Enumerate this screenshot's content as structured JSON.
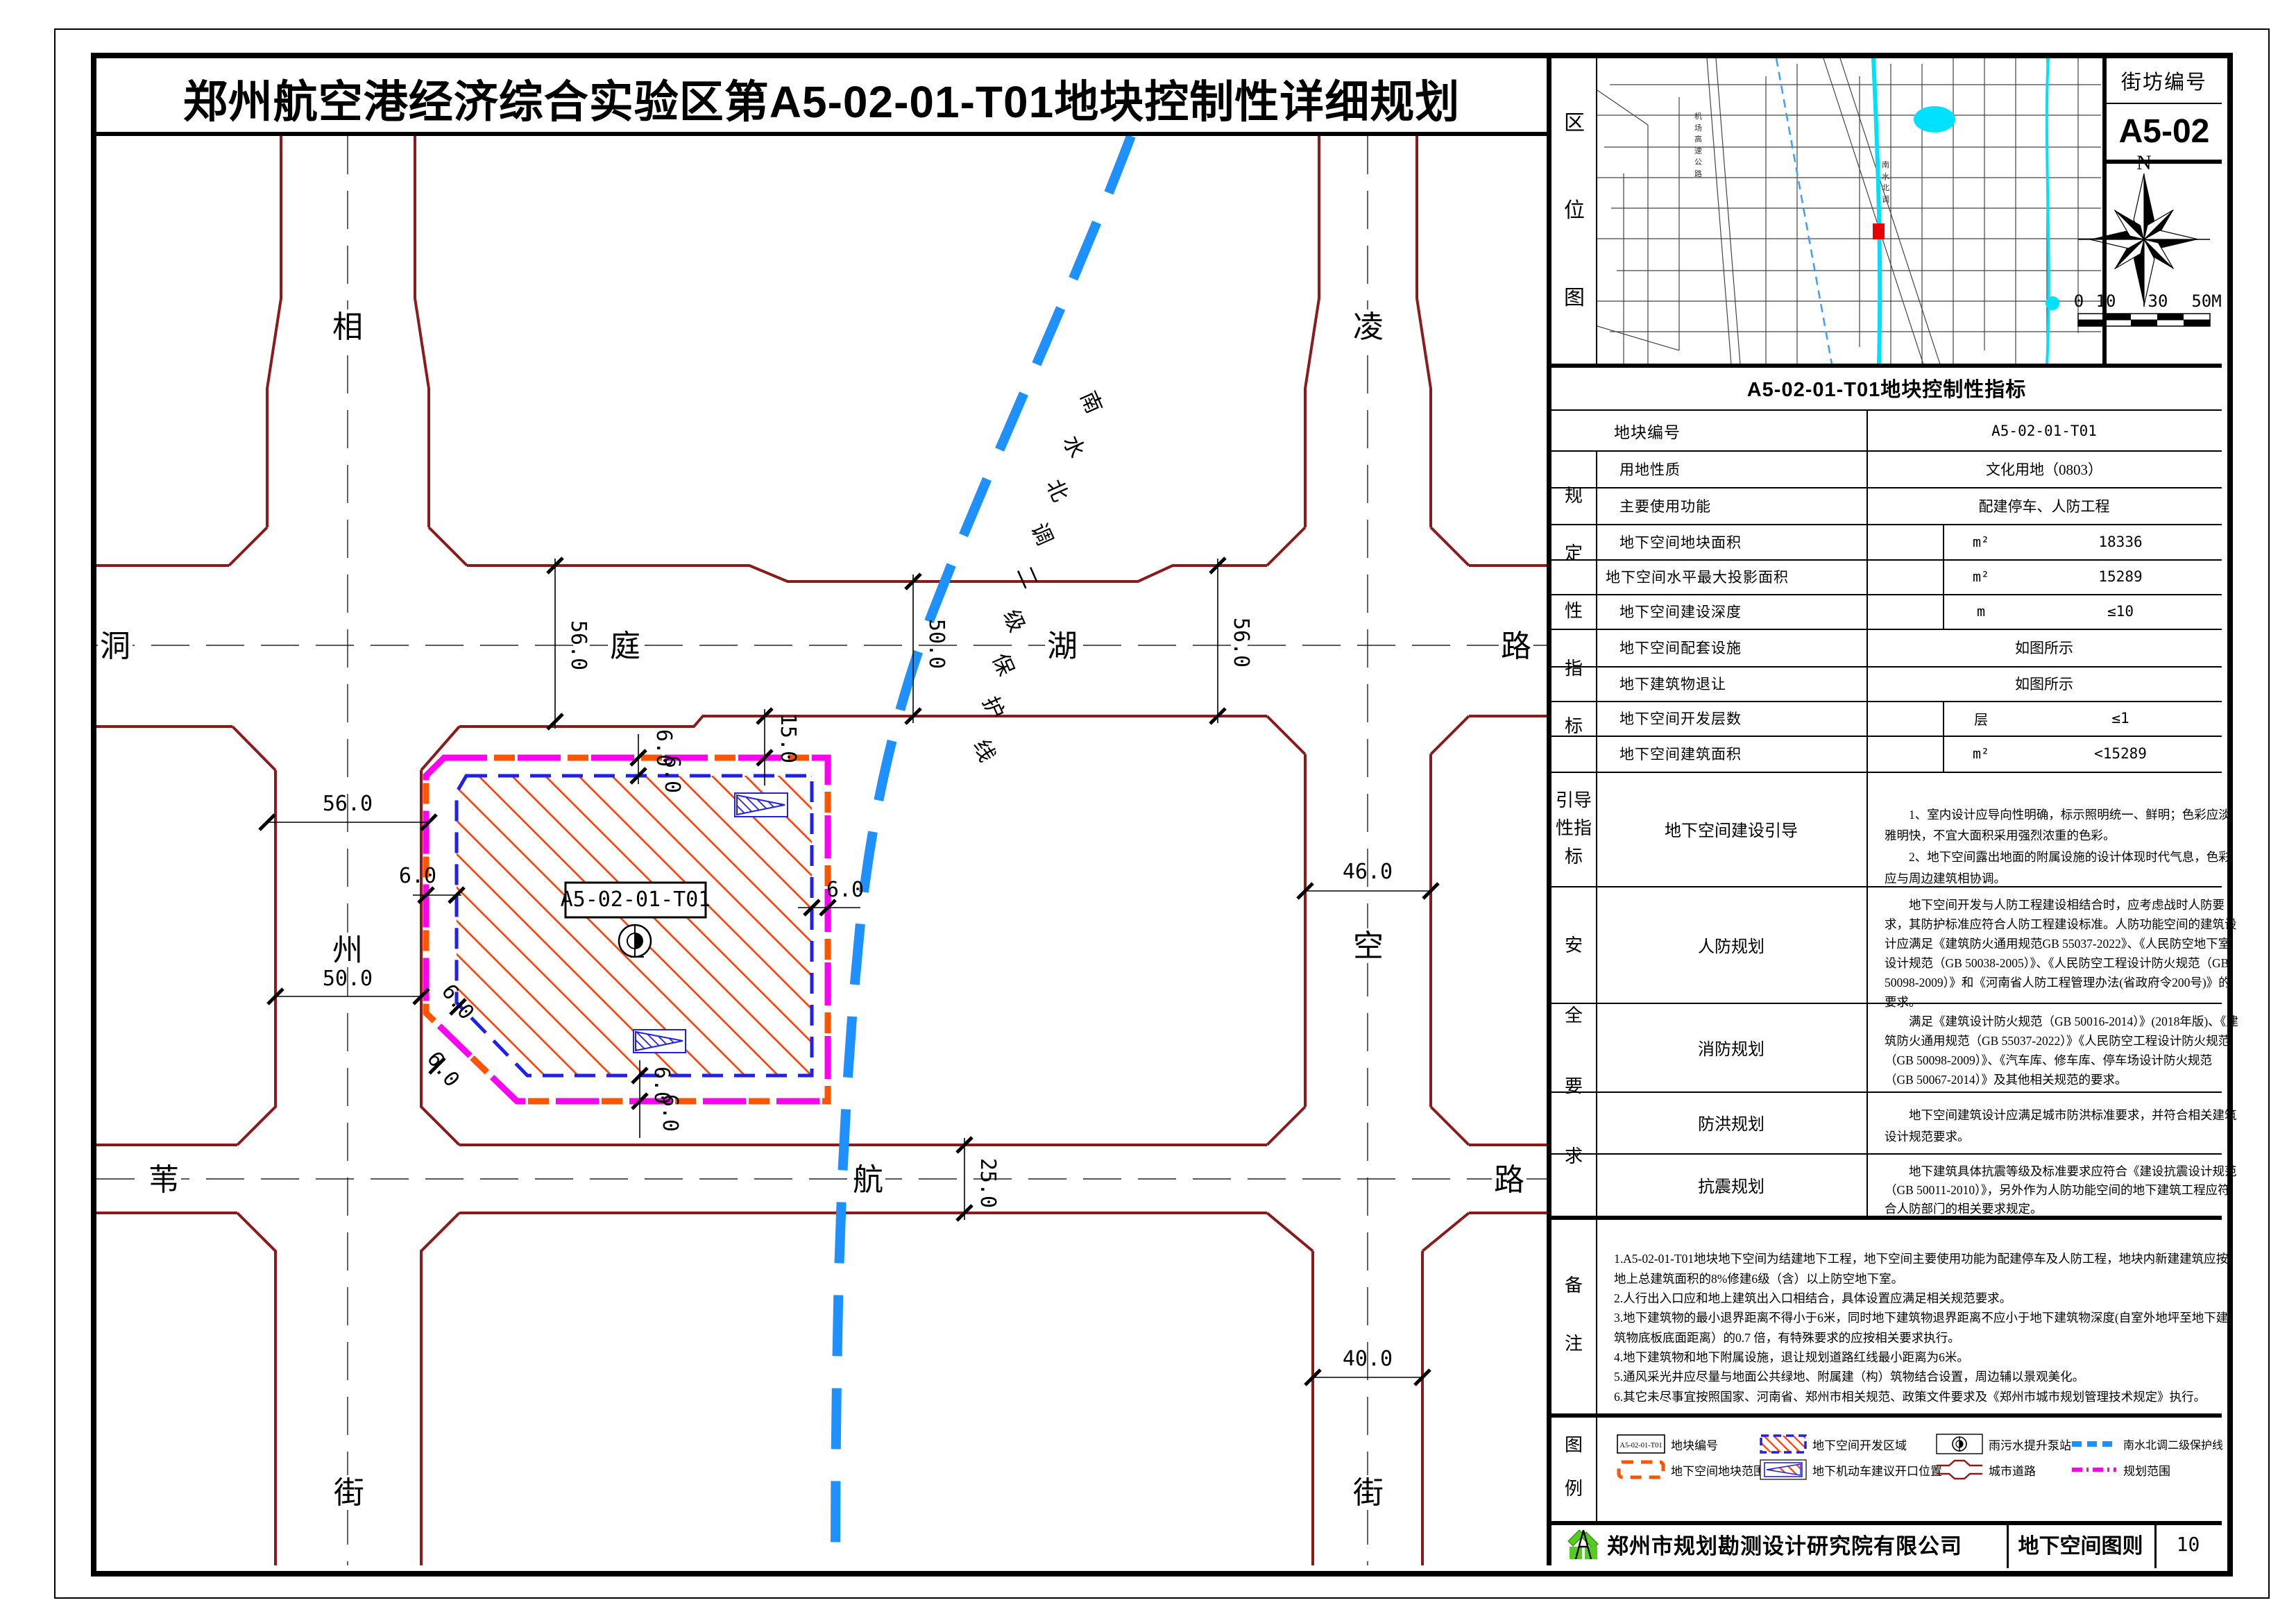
{
  "title": "郑州航空港经济综合实验区第A5-02-01-T01地块控制性详细规划",
  "location": {
    "label": "区位图",
    "block_label": "街坊编号",
    "block_no": "A5-02",
    "north": "N",
    "scale_ticks": [
      "0",
      "10",
      "30",
      "50M"
    ],
    "inset_labels": [
      "机场高速公路",
      "南水北调"
    ]
  },
  "table": {
    "header": "A5-02-01-T01地块控制性指标",
    "plot_no_label": "地块编号",
    "plot_no": "A5-02-01-T01",
    "section_regulatory": "规定性指标",
    "rows": [
      {
        "label": "用地性质",
        "unit": "",
        "value": "文化用地（0803）"
      },
      {
        "label": "主要使用功能",
        "unit": "",
        "value": "配建停车、人防工程"
      },
      {
        "label": "地下空间地块面积",
        "unit": "m²",
        "value": "18336"
      },
      {
        "label": "地下空间水平最大投影面积",
        "unit": "m²",
        "value": "15289"
      },
      {
        "label": "地下空间建设深度",
        "unit": "m",
        "value": "≤10"
      },
      {
        "label": "地下空间配套设施",
        "unit": "",
        "value": "如图所示"
      },
      {
        "label": "地下建筑物退让",
        "unit": "",
        "value": "如图所示"
      },
      {
        "label": "地下空间开发层数",
        "unit": "层",
        "value": "≤1"
      },
      {
        "label": "地下空间建筑面积",
        "unit": "m²",
        "value": "<15289"
      }
    ],
    "section_guide": "引导性指标",
    "guide_label": "地下空间建设引导",
    "guide_text": "　　1、室内设计应导向性明确，标示照明统一、鲜明；色彩应淡雅明快，不宜大面积采用强烈浓重的色彩。\n　　2、地下空间露出地面的附属设施的设计体现时代气息，色彩应与周边建筑相协调。",
    "section_safety": "安全要求",
    "safety": [
      {
        "label": "人防规划",
        "text": "　　地下空间开发与人防工程建设相结合时，应考虑战时人防要求，其防护标准应符合人防工程建设标准。人防功能空间的建筑设计应满足《建筑防火通用规范GB 55037-2022》、《人民防空地下室设计规范（GB 50038-2005）》、《人民防空工程设计防火规范（GB 50098-2009）》和《河南省人防工程管理办法(省政府令200号)》的要求。"
      },
      {
        "label": "消防规划",
        "text": "　　满足《建筑设计防火规范（GB 50016-2014）》(2018年版)、《建筑防火通用规范（GB 55037-2022）》《人民防空工程设计防火规范（GB 50098-2009）》、《汽车库、修车库、停车场设计防火规范（GB 50067-2014）》及其他相关规范的要求。"
      },
      {
        "label": "防洪规划",
        "text": "　　地下空间建筑设计应满足城市防洪标准要求，并符合相关建筑设计规范要求。"
      },
      {
        "label": "抗震规划",
        "text": "　　地下建筑具体抗震等级及标准要求应符合《建设抗震设计规范（GB 50011-2010）》，另外作为人防功能空间的地下建筑工程应符合人防部门的相关要求规定。"
      }
    ],
    "section_notes": "备注",
    "notes": "1.A5-02-01-T01地块地下空间为结建地下工程，地下空间主要使用功能为配建停车及人防工程，地块内新建建筑应按地上总建筑面积的8%修建6级（含）以上防空地下室。\n2.人行出入口应和地上建筑出入口相结合，具体设置应满足相关规范要求。\n3.地下建筑物的最小退界距离不得小于6米，同时地下建筑物退界距离不应小于地下建筑物深度(自室外地坪至地下建 筑物底板底面距离）的0.7 倍，有特殊要求的应按相关要求执行。\n4.地下建筑物和地下附属设施，退让规划道路红线最小距离为6米。\n5.通风采光井应尽量与地面公共绿地、附属建（构）筑物结合设置，周边辅以景观美化。\n6.其它未尽事宜按照国家、河南省、郑州市相关规范、政策文件要求及《郑州市城市规划管理技术规定》执行。",
    "section_legend": "图例"
  },
  "legend": {
    "items": [
      {
        "name": "地块编号"
      },
      {
        "name": "地下空间开发区域"
      },
      {
        "name": "雨污水提升泵站"
      },
      {
        "name": "南水北调二级保护线"
      },
      {
        "name": "地下空间地块范围"
      },
      {
        "name": "地下机动车建议开口位置"
      },
      {
        "name": "城市道路"
      },
      {
        "name": "规划范围"
      }
    ],
    "plot_box_text": "A5-02-01-T01"
  },
  "footer": {
    "company": "郑州市规划勘测设计研究院有限公司",
    "sheet_name": "地下空间图则",
    "page": "10"
  },
  "map": {
    "parcel_label": "A5-02-01-T01",
    "north_road": [
      "洞",
      "庭",
      "湖",
      "路"
    ],
    "south_road": [
      "苇",
      "航",
      "路"
    ],
    "west_road": [
      "相",
      "州",
      "街"
    ],
    "east_road": [
      "凌",
      "空",
      "街"
    ],
    "dims": [
      "56.0",
      "50.0",
      "56.0",
      "56.0",
      "50.0",
      "46.0",
      "40.0",
      "25.0",
      "15.0",
      "6.0",
      "6.0",
      "6.0",
      "6.0",
      "6.0",
      "6.0",
      "6.0",
      "6.0"
    ],
    "protect": [
      "南",
      "水",
      "北",
      "调",
      "二",
      "级",
      "保",
      "护",
      "线"
    ]
  }
}
